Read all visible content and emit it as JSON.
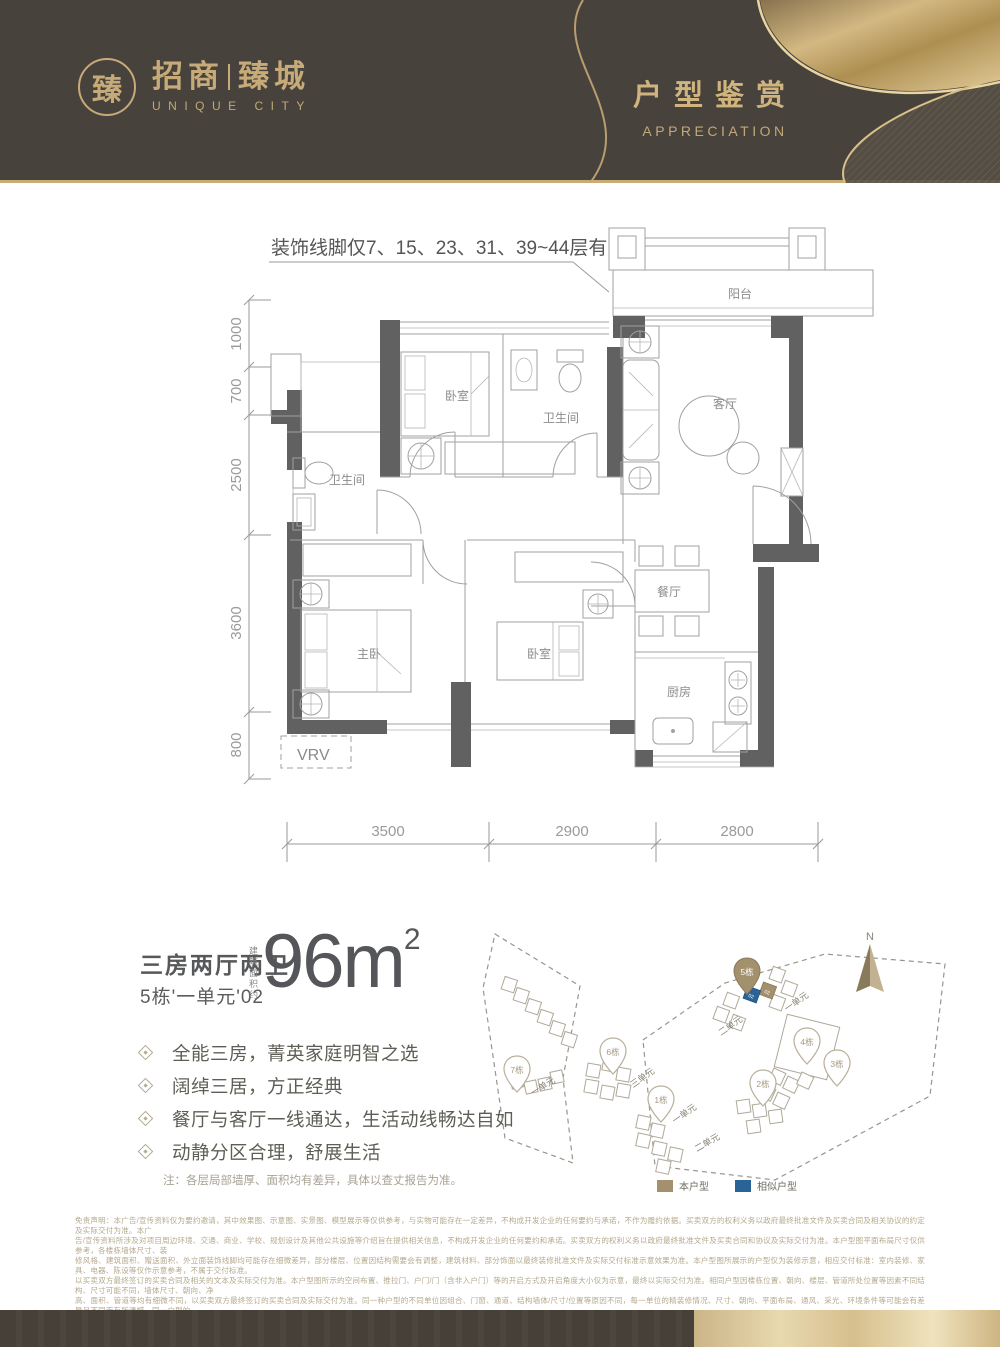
{
  "header": {
    "seal_char": "臻",
    "brand_left": "招商",
    "brand_right": "臻城",
    "brand_en": "UNIQUE CITY",
    "title": "户型鉴赏",
    "title_en": "APPRECIATION"
  },
  "floorplan": {
    "annotation": "装饰线脚仅7、15、23、31、39~44层有",
    "rooms": {
      "balcony": "阳台",
      "living": "客厅",
      "bedroom_top": "卧室",
      "bath_mid": "卫生间",
      "bath_left": "卫生间",
      "master": "主卧",
      "bedroom_mid": "卧室",
      "dining": "餐厅",
      "kitchen": "厨房",
      "vrv": "VRV"
    },
    "dims_left": [
      "1000",
      "700",
      "2500",
      "3600",
      "800"
    ],
    "dims_bottom": [
      "3500",
      "2900",
      "2800"
    ]
  },
  "info": {
    "layout": "三房两厅两卫",
    "unit": "5栋'一单元'02",
    "area_label": "建筑面积约",
    "area_value": "96m",
    "area_exponent": "2",
    "features": [
      "全能三房，菁英家庭明智之选",
      "阔绰三居，方正经典",
      "餐厅与客厅一线通达，生活动线畅达自如",
      "动静分区合理，舒展生活"
    ],
    "note": "注：各层局部墙厚、面积均有差异，具体以查丈报告为准。"
  },
  "siteplan": {
    "north": "N",
    "pins": {
      "p7": "7栋",
      "p6": "6栋",
      "p5": "5栋",
      "p4": "4栋",
      "p3": "3栋",
      "p2": "2栋",
      "p1": "1栋"
    },
    "unit_labels": {
      "parcel_left": "一单元",
      "b6": "三单元",
      "b5_right": "一单元",
      "b5_left": "二单元",
      "b1_top": "一单元",
      "b1_bottom": "二单元"
    },
    "b5_units": {
      "this": "02",
      "similar": "02"
    },
    "legend": [
      {
        "label": "本户型",
        "color": "#a3906c"
      },
      {
        "label": "相似户型",
        "color": "#2a6496"
      }
    ]
  },
  "disclaimer": {
    "lines": [
      "免责声明：本广告/宣传资料仅为要约邀请，其中效果图、示意图、实景图、模型展示等仅供参考，与实物可能存在一定差异，不构成开发企业的任何要约与承诺，不作为履约依据。买卖双方的权利义务以政府最终批准文件及买卖合同及相关协议的约定及实际交付为准。本广",
      "告/宣传资料所涉及对项目周边环境、交通、商业、学校、规划设计及其他公共设施等介绍旨在提供相关信息，不构成开发企业的任何要约和承诺。买卖双方的权利义务以政府最终批准文件及买卖合同和协议及实际交付为准。本户型图平面布局尺寸仅供参考，各楼栋墙体尺寸、装",
      "修风格、建筑面积、赠送面积、外立面装饰线脚均可能存在细微差异，部分楼层、位置因结构需要会有调整，建筑材料、部分饰面以最终装修批准文件及实际交付标准示意效果为准。本户型图所展示的户型仅为装修示意，相应交付标准：室内装修、家具、电器、陈设等仅作示意参考，不属于交付标准。",
      "以买卖双方最终签订的买卖合同及相关的文本及实际交付为准。本户型图所示的空间布置、推拉门、户门/门（含非入户门）等的开启方式及开启角度大小仅为示意，最终以实际交付为准。相同户型因楼栋位置、朝向、楼层、管道所处位置等因素不同结构、尺寸可能不同，墙体尺寸、朝向、净",
      "高、面积、管道等均有细微不同，以买卖双方最终签订的买卖合同及实际交付为准。同一种户型的不同单位因组合、门窗、通道、结构墙体/尺寸/位置等原因不同，每一单位的精装修情况、尺寸、朝向、平面布局、通风、采光、环境条件等可能会有差异且不同而有所遗憾，同一户型的",
      "外立面装饰线脚、部分公共空间可能会因所在楼栋位置不同而有差异，以买卖双方最终签订的买卖合同及相关协议及实际交付为准。本广告/宣传资料发布时间为2023年3月，所发布的内容为2023年3月前的信息，后续变化请参考最新楼书、微信公众号等资料，本广告/宣传资料",
      "最终解释权归招商蛇口深圳公司所有。本项目备案名为\"臻城花园\"（推广名：招商臻城）。本项目开发企业：深圳招商置业有限公司。制作日期：2023年3月【广告】。"
    ]
  },
  "colors": {
    "header_bg": "#48423d",
    "gold": "#c6ab79",
    "wall": "#616161",
    "pin_gold": "#a3906c",
    "similar_blue": "#2a6496"
  }
}
